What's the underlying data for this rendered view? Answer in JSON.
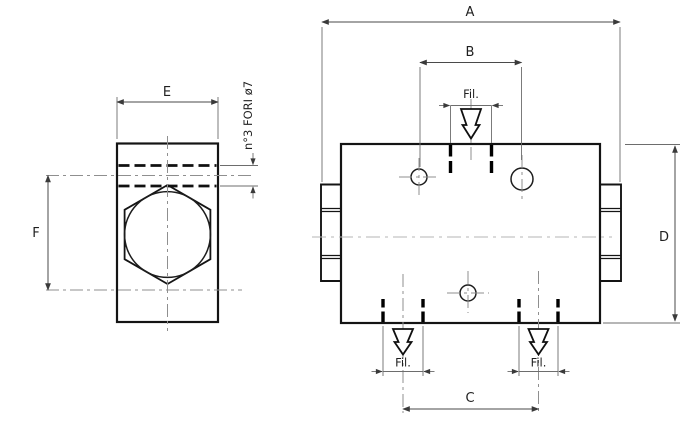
{
  "drawing": {
    "kind": "technical-drawing-2-views",
    "labels": {
      "dim_a": "A",
      "dim_b": "B",
      "dim_c": "C",
      "dim_d": "D",
      "dim_e": "E",
      "dim_f": "F"
    },
    "notes": {
      "holes_note": "n°3 FORI ø7",
      "thread_top": "Fil.",
      "thread_bottom_left": "Fil.",
      "thread_bottom_right": "Fil."
    },
    "symbols": {
      "thread_port_icon": "hollow-down-arrow"
    },
    "colors": {
      "background": "#ffffff",
      "outline": "#141414",
      "dimension_line": "#4a4a4a",
      "center_line": "#8f8f8f"
    }
  }
}
